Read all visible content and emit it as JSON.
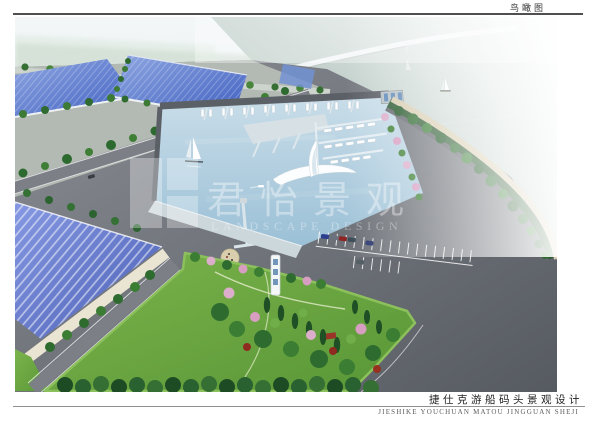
{
  "page": {
    "top_label": "鸟瞰图",
    "bottom_title_cn": "捷仕克游船码头景观设计",
    "bottom_title_en": "JIESHIKE YOUCHUAN MATOU JINGGUAN SHEJI"
  },
  "watermark": {
    "brand_cn": "君怡景观",
    "brand_en": "LANDSCAPE DESIGN"
  },
  "scene": {
    "colors": {
      "sea": "#a3b7ae",
      "marina_water": "#a9c9dc",
      "pond_blue": "#4f6cc2",
      "roof_blue": "#5d74ce",
      "wall_cream": "#eae4d2",
      "asphalt": "#6e7278",
      "lawn_green": "#69a83e",
      "tree_dark": "#2c6330",
      "blossom_pink": "#dcaecb",
      "shore_path": "#d8cdb0",
      "quay": "#ccd7dc",
      "plaza_sand": "#d9cfae"
    }
  }
}
